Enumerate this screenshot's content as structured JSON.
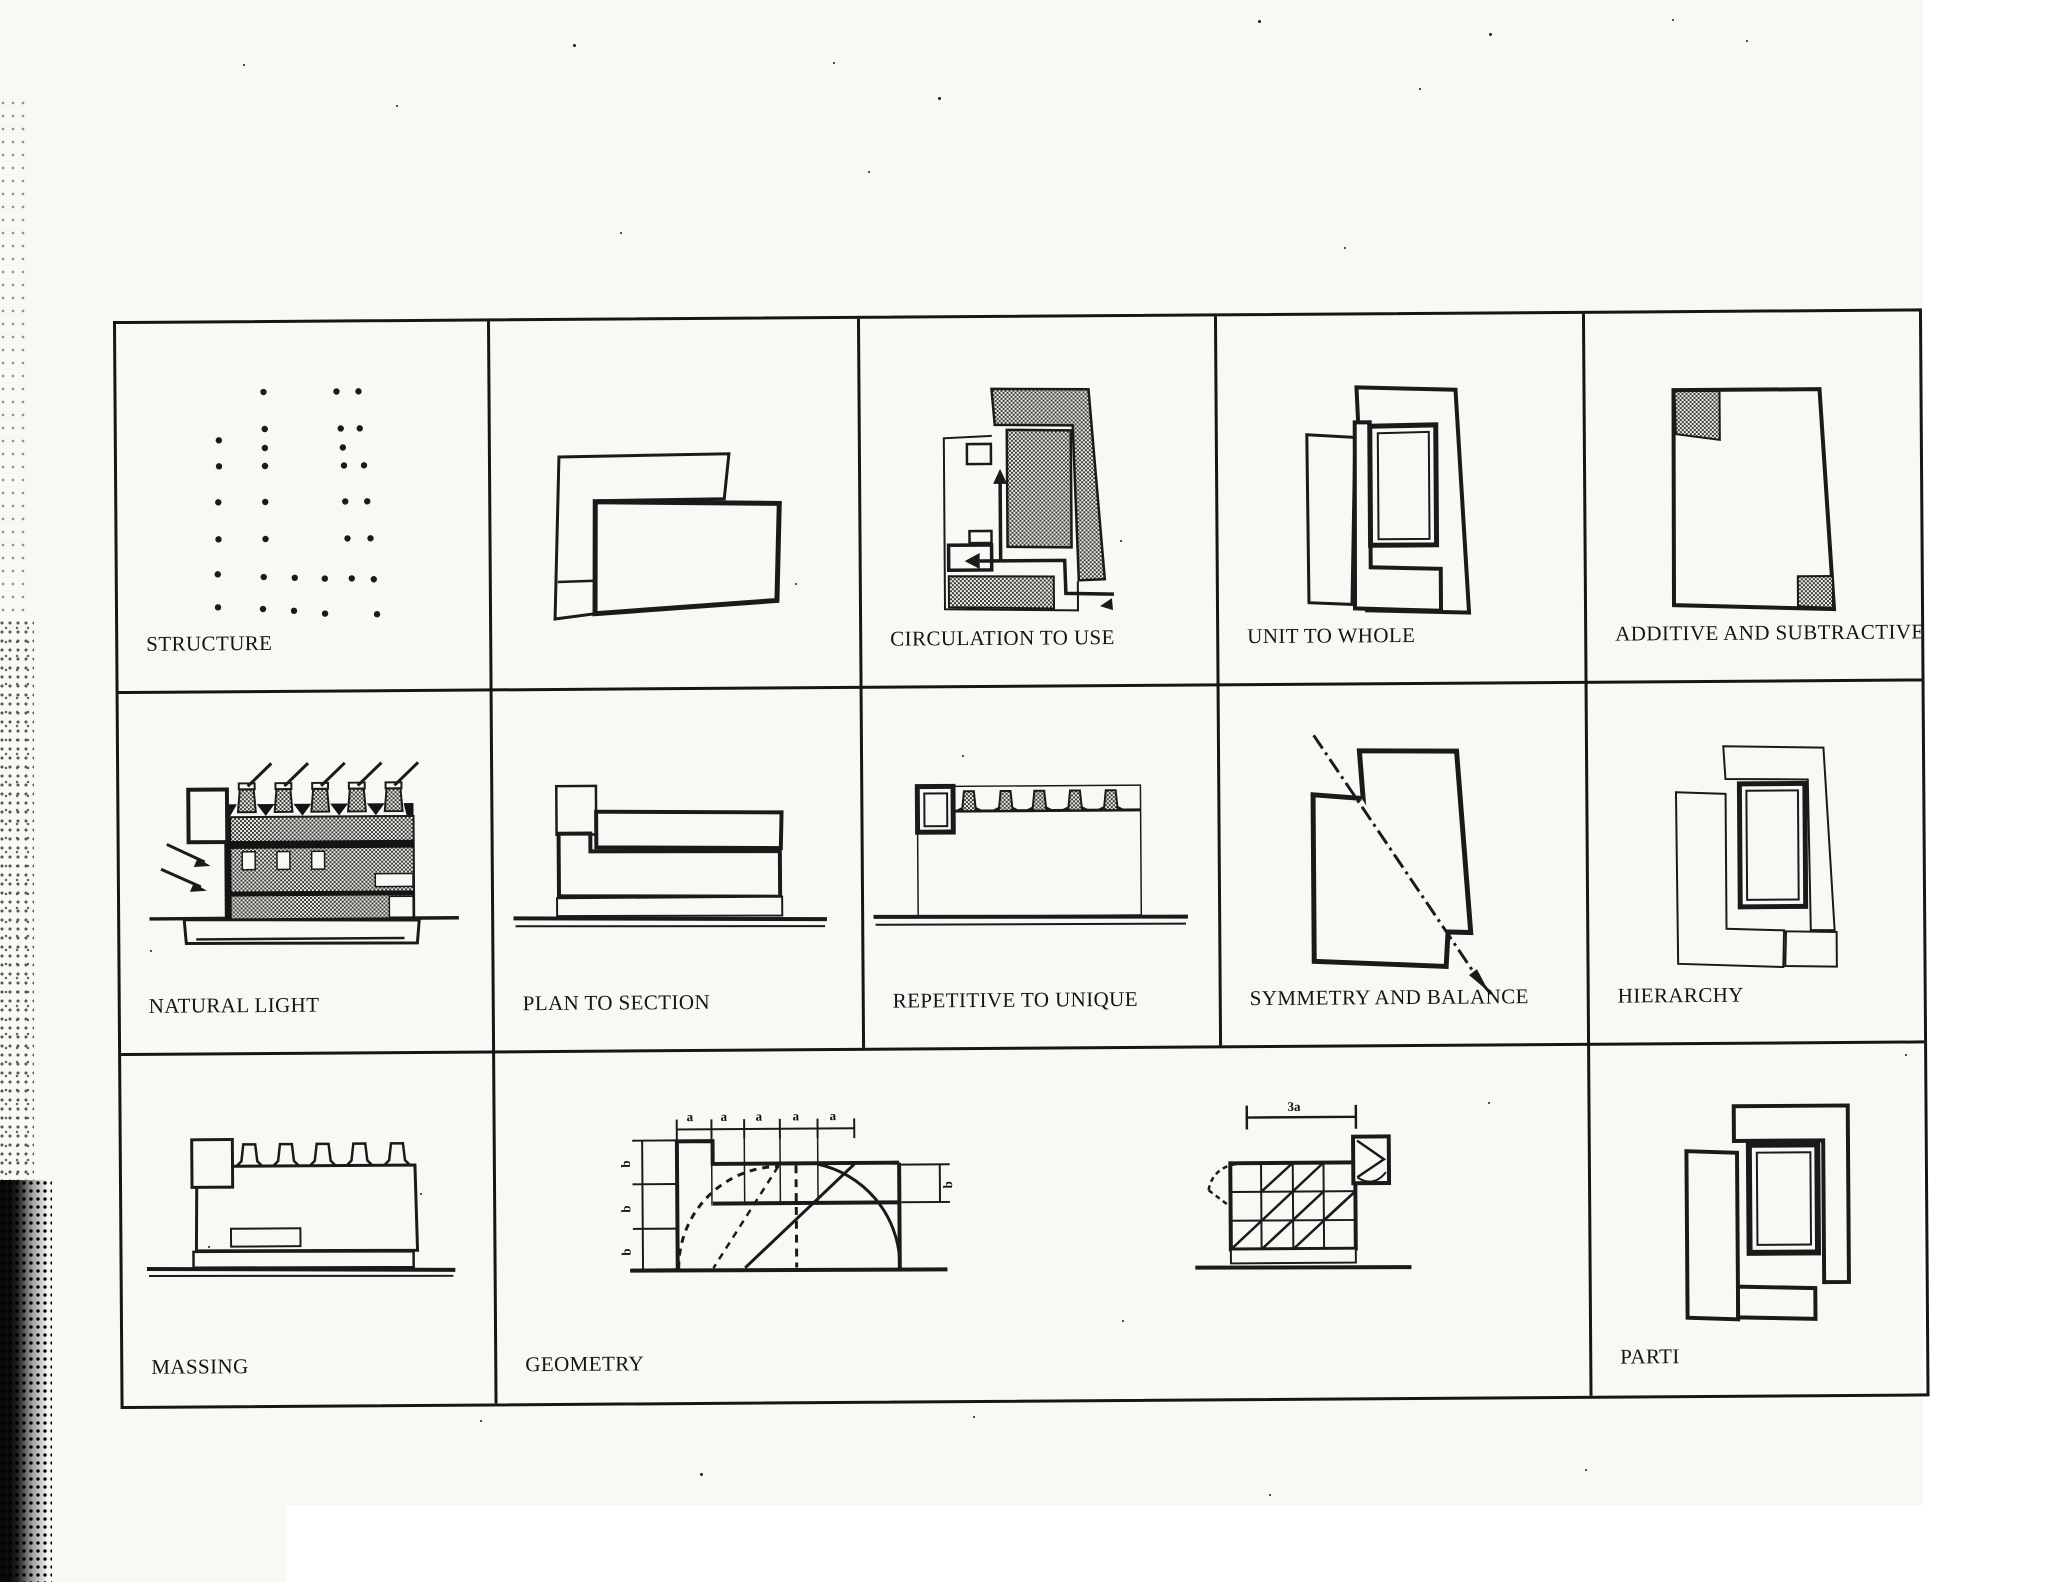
{
  "sheet": {
    "description": "Scanned matrix of architectural precedent analysis diagrams",
    "colors": {
      "paper": "#f8f8f5",
      "ink": "#1a1a1a",
      "stipple_dark": "#3b3b39"
    }
  },
  "cells": {
    "structure": {
      "label": "STRUCTURE"
    },
    "untitled_plan": {
      "label": ""
    },
    "circulation_to_use": {
      "label": "CIRCULATION TO USE"
    },
    "unit_to_whole": {
      "label": "UNIT TO WHOLE"
    },
    "additive_and_subtractive": {
      "label": "ADDITIVE AND SUBTRACTIVE"
    },
    "natural_light": {
      "label": "NATURAL LIGHT"
    },
    "plan_to_section": {
      "label": "PLAN TO SECTION"
    },
    "repetitive_to_unique": {
      "label": "REPETITIVE TO UNIQUE"
    },
    "symmetry_and_balance": {
      "label": "SYMMETRY AND BALANCE"
    },
    "hierarchy": {
      "label": "HIERARCHY"
    },
    "massing": {
      "label": "MASSING"
    },
    "geometry": {
      "label": "GEOMETRY",
      "dim_a": "a",
      "dim_b": "b"
    },
    "grid_square": {
      "dim_3a": "3a"
    },
    "parti": {
      "label": "PARTI"
    }
  }
}
